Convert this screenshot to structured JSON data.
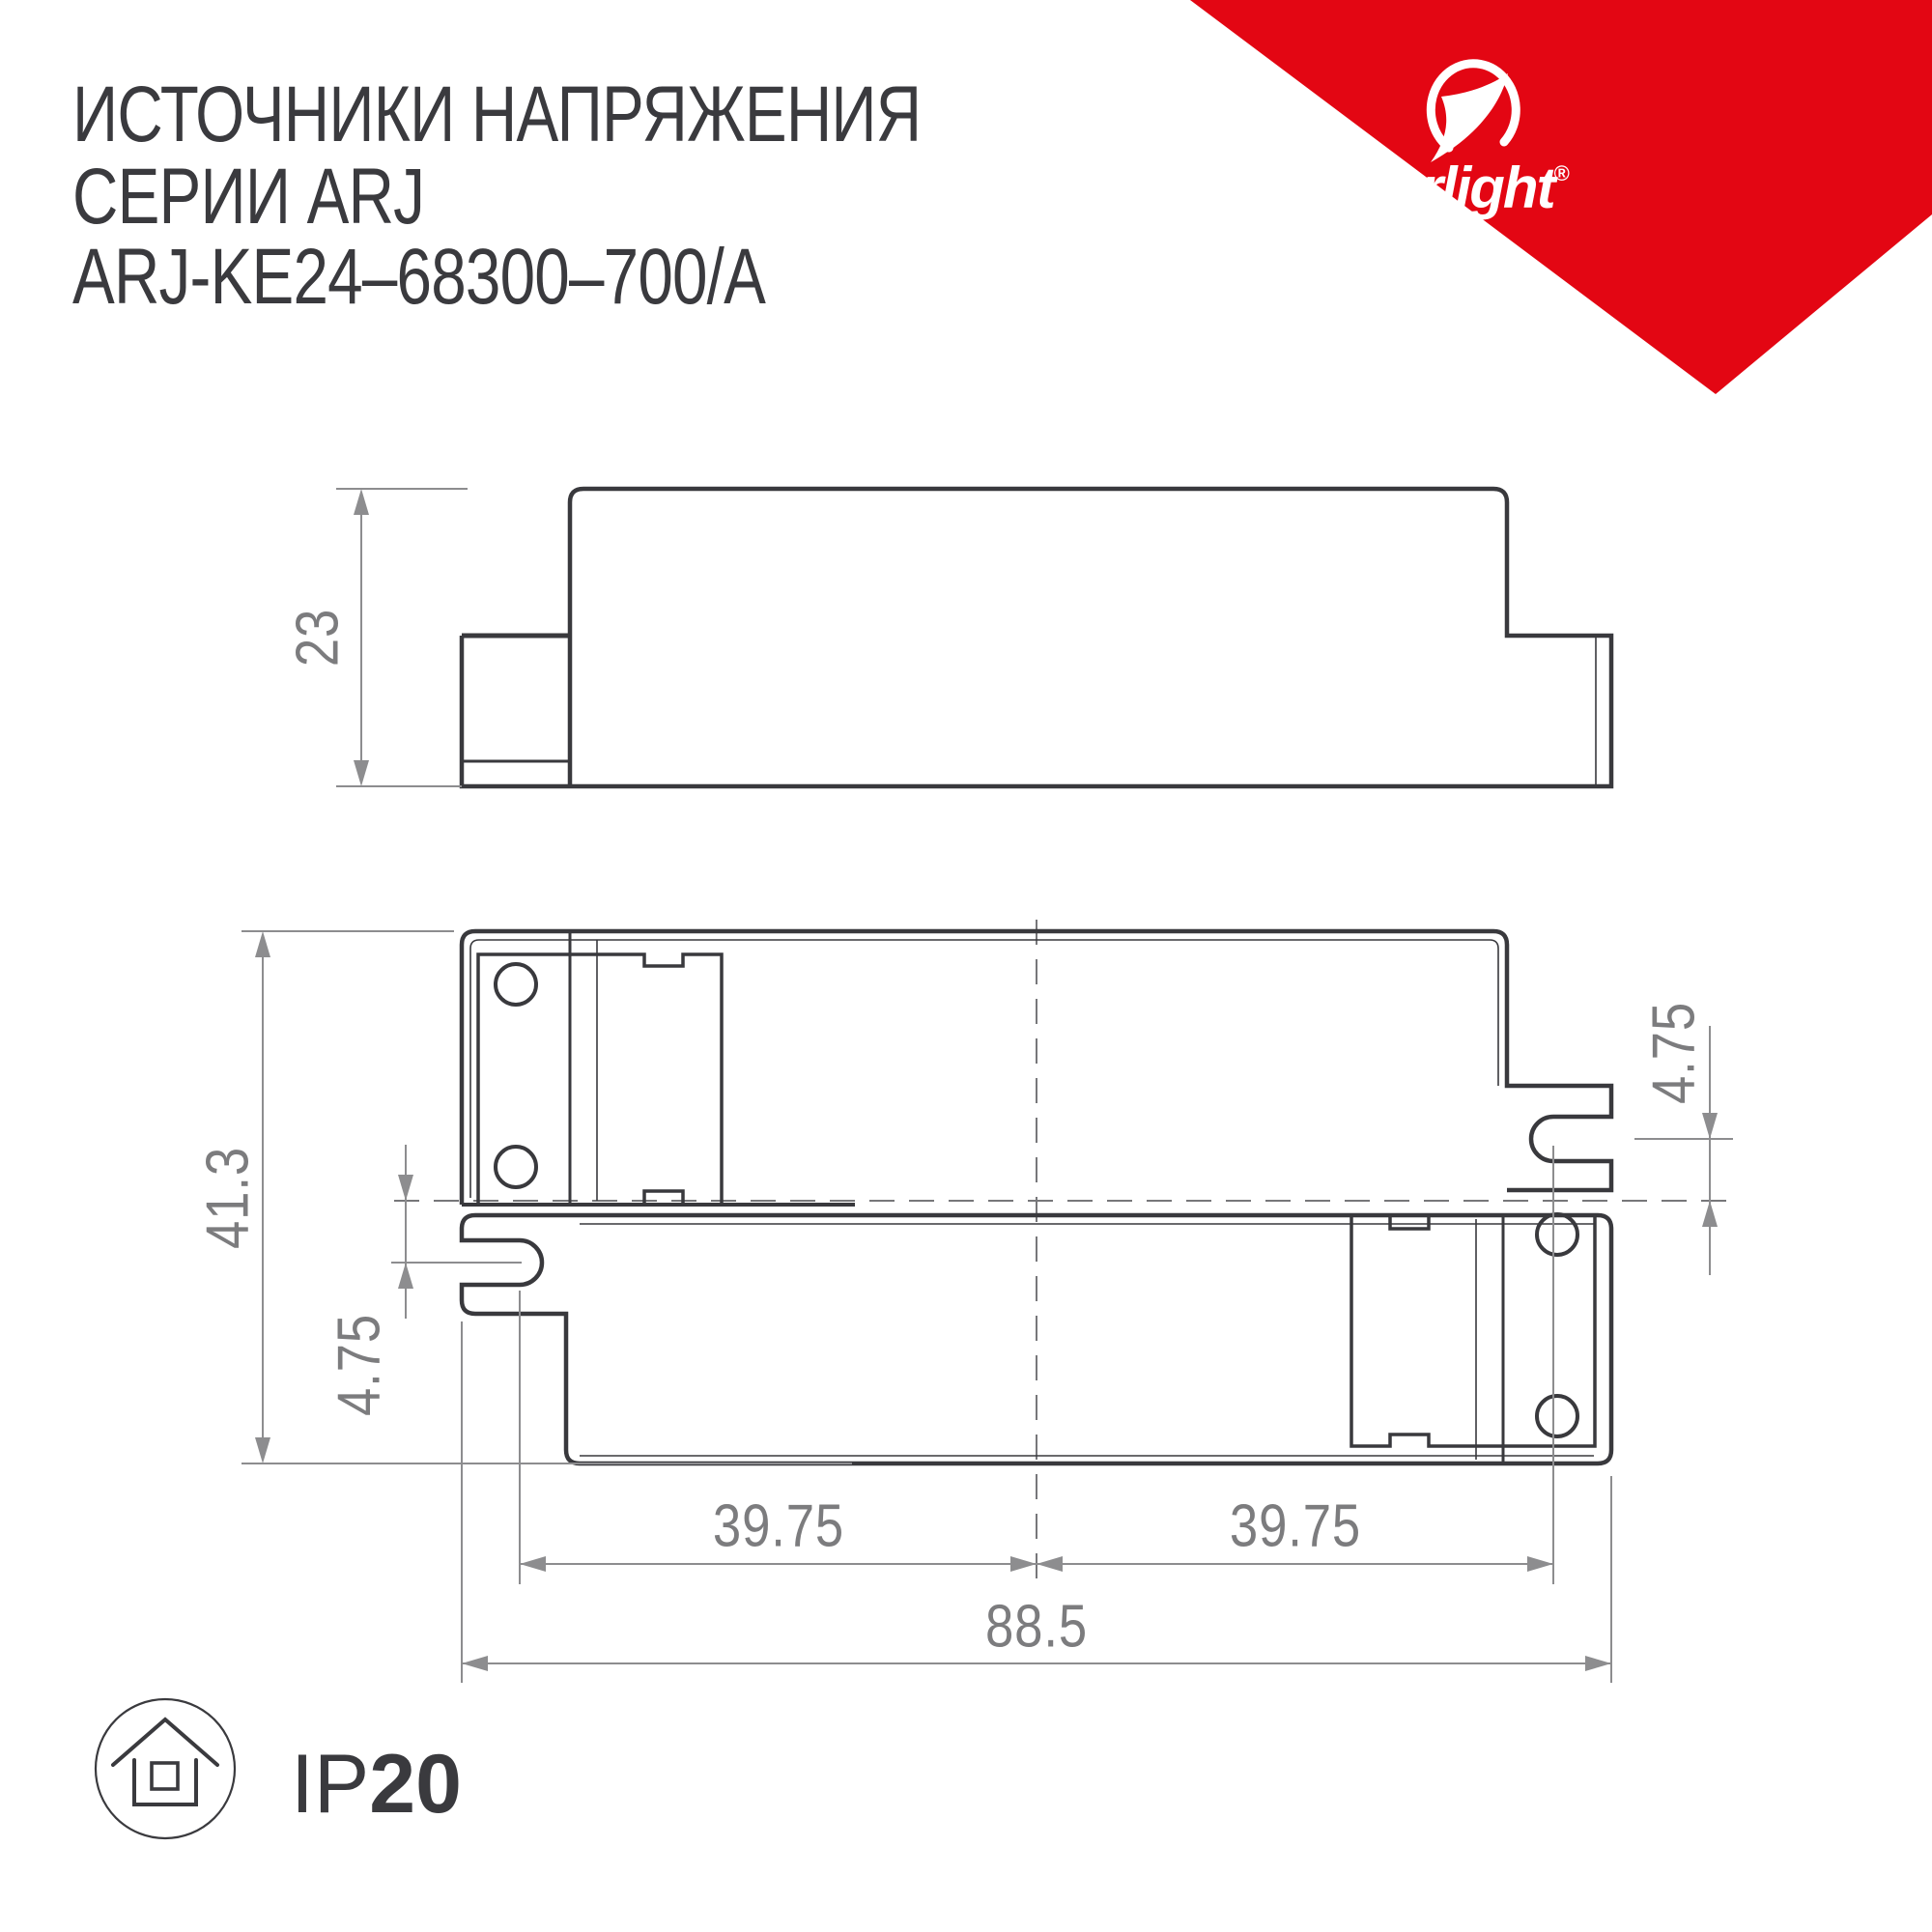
{
  "title": {
    "line1": "ИСТОЧНИКИ НАПРЯЖЕНИЯ",
    "line2": "СЕРИИ ARJ",
    "line3": "ARJ-KE24–68300–700/A"
  },
  "brand": {
    "name": "arlight",
    "registered_mark": "®"
  },
  "dimensions": {
    "side_height": "23",
    "overall_height": "41.3",
    "slot_offset_left": "4.75",
    "slot_offset_right": "4.75",
    "slot_spacing_left": "39.75",
    "slot_spacing_right": "39.75",
    "overall_width": "88.5"
  },
  "badge": {
    "ip_prefix": "IP",
    "ip_rating": "20"
  },
  "colors": {
    "accent_red": "#e30613",
    "line_dark": "#39393d",
    "dim_gray": "#8d8d8f",
    "text_gray": "#7c7c7e"
  }
}
